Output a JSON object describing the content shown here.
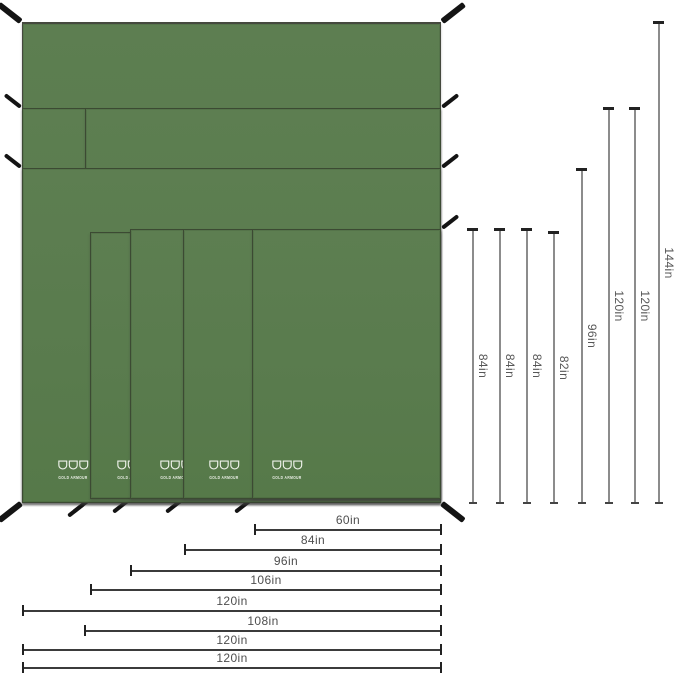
{
  "brand": {
    "logo_text": "GOLD ARMOUR"
  },
  "colors": {
    "background": "#ffffff",
    "tarp_green": "#5b7c4f",
    "tarp_seam": "#3c4a33",
    "tie_black": "#141414",
    "dim_line_dark": "#3b3b3b",
    "dim_line_gray": "#8c8c8c",
    "label_gray": "#4f4f4f",
    "logo_white": "#eef2ea"
  },
  "tarps": [
    {
      "name": "tarp-120x144",
      "width": "120in",
      "height": "144in",
      "show_logo": false
    },
    {
      "name": "tarp-120x120",
      "width": "120in",
      "height": "120in",
      "show_logo": false
    },
    {
      "name": "tarp-108x120",
      "width": "108in",
      "height": "120in",
      "show_logo": false
    },
    {
      "name": "tarp-120x96",
      "width": "120in",
      "height": "96in",
      "show_logo": true
    },
    {
      "name": "tarp-106x82",
      "width": "106in",
      "height": "82in",
      "show_logo": true
    },
    {
      "name": "tarp-96x84",
      "width": "96in",
      "height": "84in",
      "show_logo": true
    },
    {
      "name": "tarp-84x84",
      "width": "84in",
      "height": "84in",
      "show_logo": true
    },
    {
      "name": "tarp-60x84",
      "width": "60in",
      "height": "84in",
      "show_logo": true
    }
  ],
  "bottom_dimension_labels": [
    "60in",
    "84in",
    "96in",
    "106in",
    "120in",
    "108in",
    "120in",
    "120in"
  ],
  "right_dimension_labels": [
    "84in",
    "84in",
    "84in",
    "82in",
    "96in",
    "120in",
    "120in",
    "144in"
  ]
}
